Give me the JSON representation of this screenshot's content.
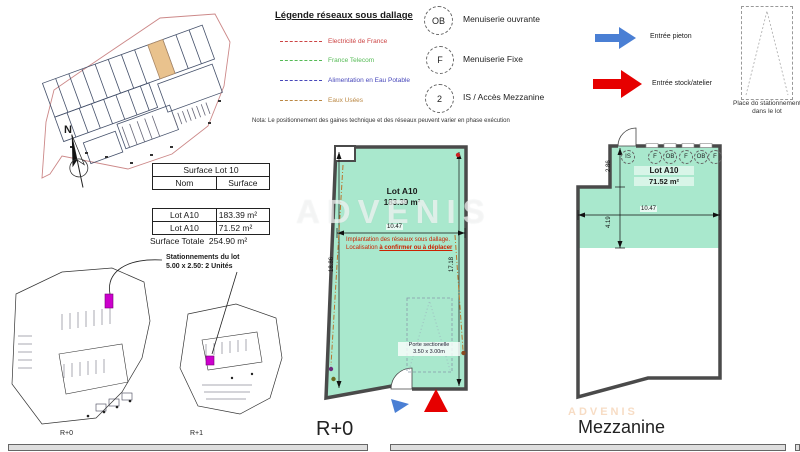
{
  "watermark": "ADVENIS",
  "compass": {
    "n": "N"
  },
  "legend": {
    "title": "Légende réseaux sous dallage",
    "items": [
      {
        "label": "Electricité de France",
        "color": "#cc4444"
      },
      {
        "label": "France Telecom",
        "color": "#55bb55"
      },
      {
        "label": "Alimentation en Eau Potable",
        "color": "#4848bb"
      },
      {
        "label": "Eaux Usées",
        "color": "#bb8844"
      }
    ],
    "nota": "Nota: Le positionnement des gaines technique et des réseaux peuvent varier en phase exécution"
  },
  "symbols": {
    "items": [
      {
        "badge": "OB",
        "label": "Menuiserie ouvrante"
      },
      {
        "badge": "F",
        "label": "Menuiserie Fixe"
      },
      {
        "badge": "2",
        "label": "IS / Accès Mezzanine"
      }
    ]
  },
  "entries": {
    "pieton": "Entrée pieton",
    "stock": "Entrée stock/atelier"
  },
  "parking_symbol": {
    "caption_line1": "Place do stationnement",
    "caption_line2": "dans le lot"
  },
  "surface_table": {
    "title": "Surface Lot 10",
    "col_nom": "Nom",
    "col_surface": "Surface",
    "rows": [
      {
        "nom": "Lot A10",
        "surface": "183.39 m²"
      },
      {
        "nom": "Lot A10",
        "surface": "71.52 m²"
      }
    ],
    "total_label": "Surface Totale",
    "total_value": "254.90 m²"
  },
  "stationnements": {
    "line1": "Stationnements du lot",
    "line2": "5.00 x 2.50: 2 Unités"
  },
  "mini_plans": {
    "r0_label": "R+0",
    "r1_label": "R+1"
  },
  "plan_r0": {
    "title": "R+0",
    "lot_name": "Lot A10",
    "lot_area": "183.39 m²",
    "dim_width": "10.47",
    "dim_left": "18.86",
    "dim_right": "17.18",
    "note_line1": "Implantation des réseaux sous dallage.",
    "note_line2_prefix": "Localisation ",
    "note_line2_underlined": "à confirmer ou à déplacer",
    "door_line1": "Porte sectionelle",
    "door_line2": "3.50 x 3.00m"
  },
  "plan_mezzanine": {
    "title": "Mezzanine",
    "lot_name": "Lot A10",
    "lot_area": "71.52 m²",
    "dim_width": "10.47",
    "dim_upper": "2.86",
    "dim_lower": "4.19",
    "badges": [
      "IS",
      "F",
      "OB",
      "F",
      "OB",
      "F"
    ]
  },
  "colors": {
    "plan_fill": "#a9e8cd",
    "wall": "#4a4a4a",
    "entry_pieton": "#4a7fd4",
    "entry_stock": "#e60000",
    "parking_highlight": "#cc00cc",
    "lot_highlight": "#e9c28d"
  }
}
